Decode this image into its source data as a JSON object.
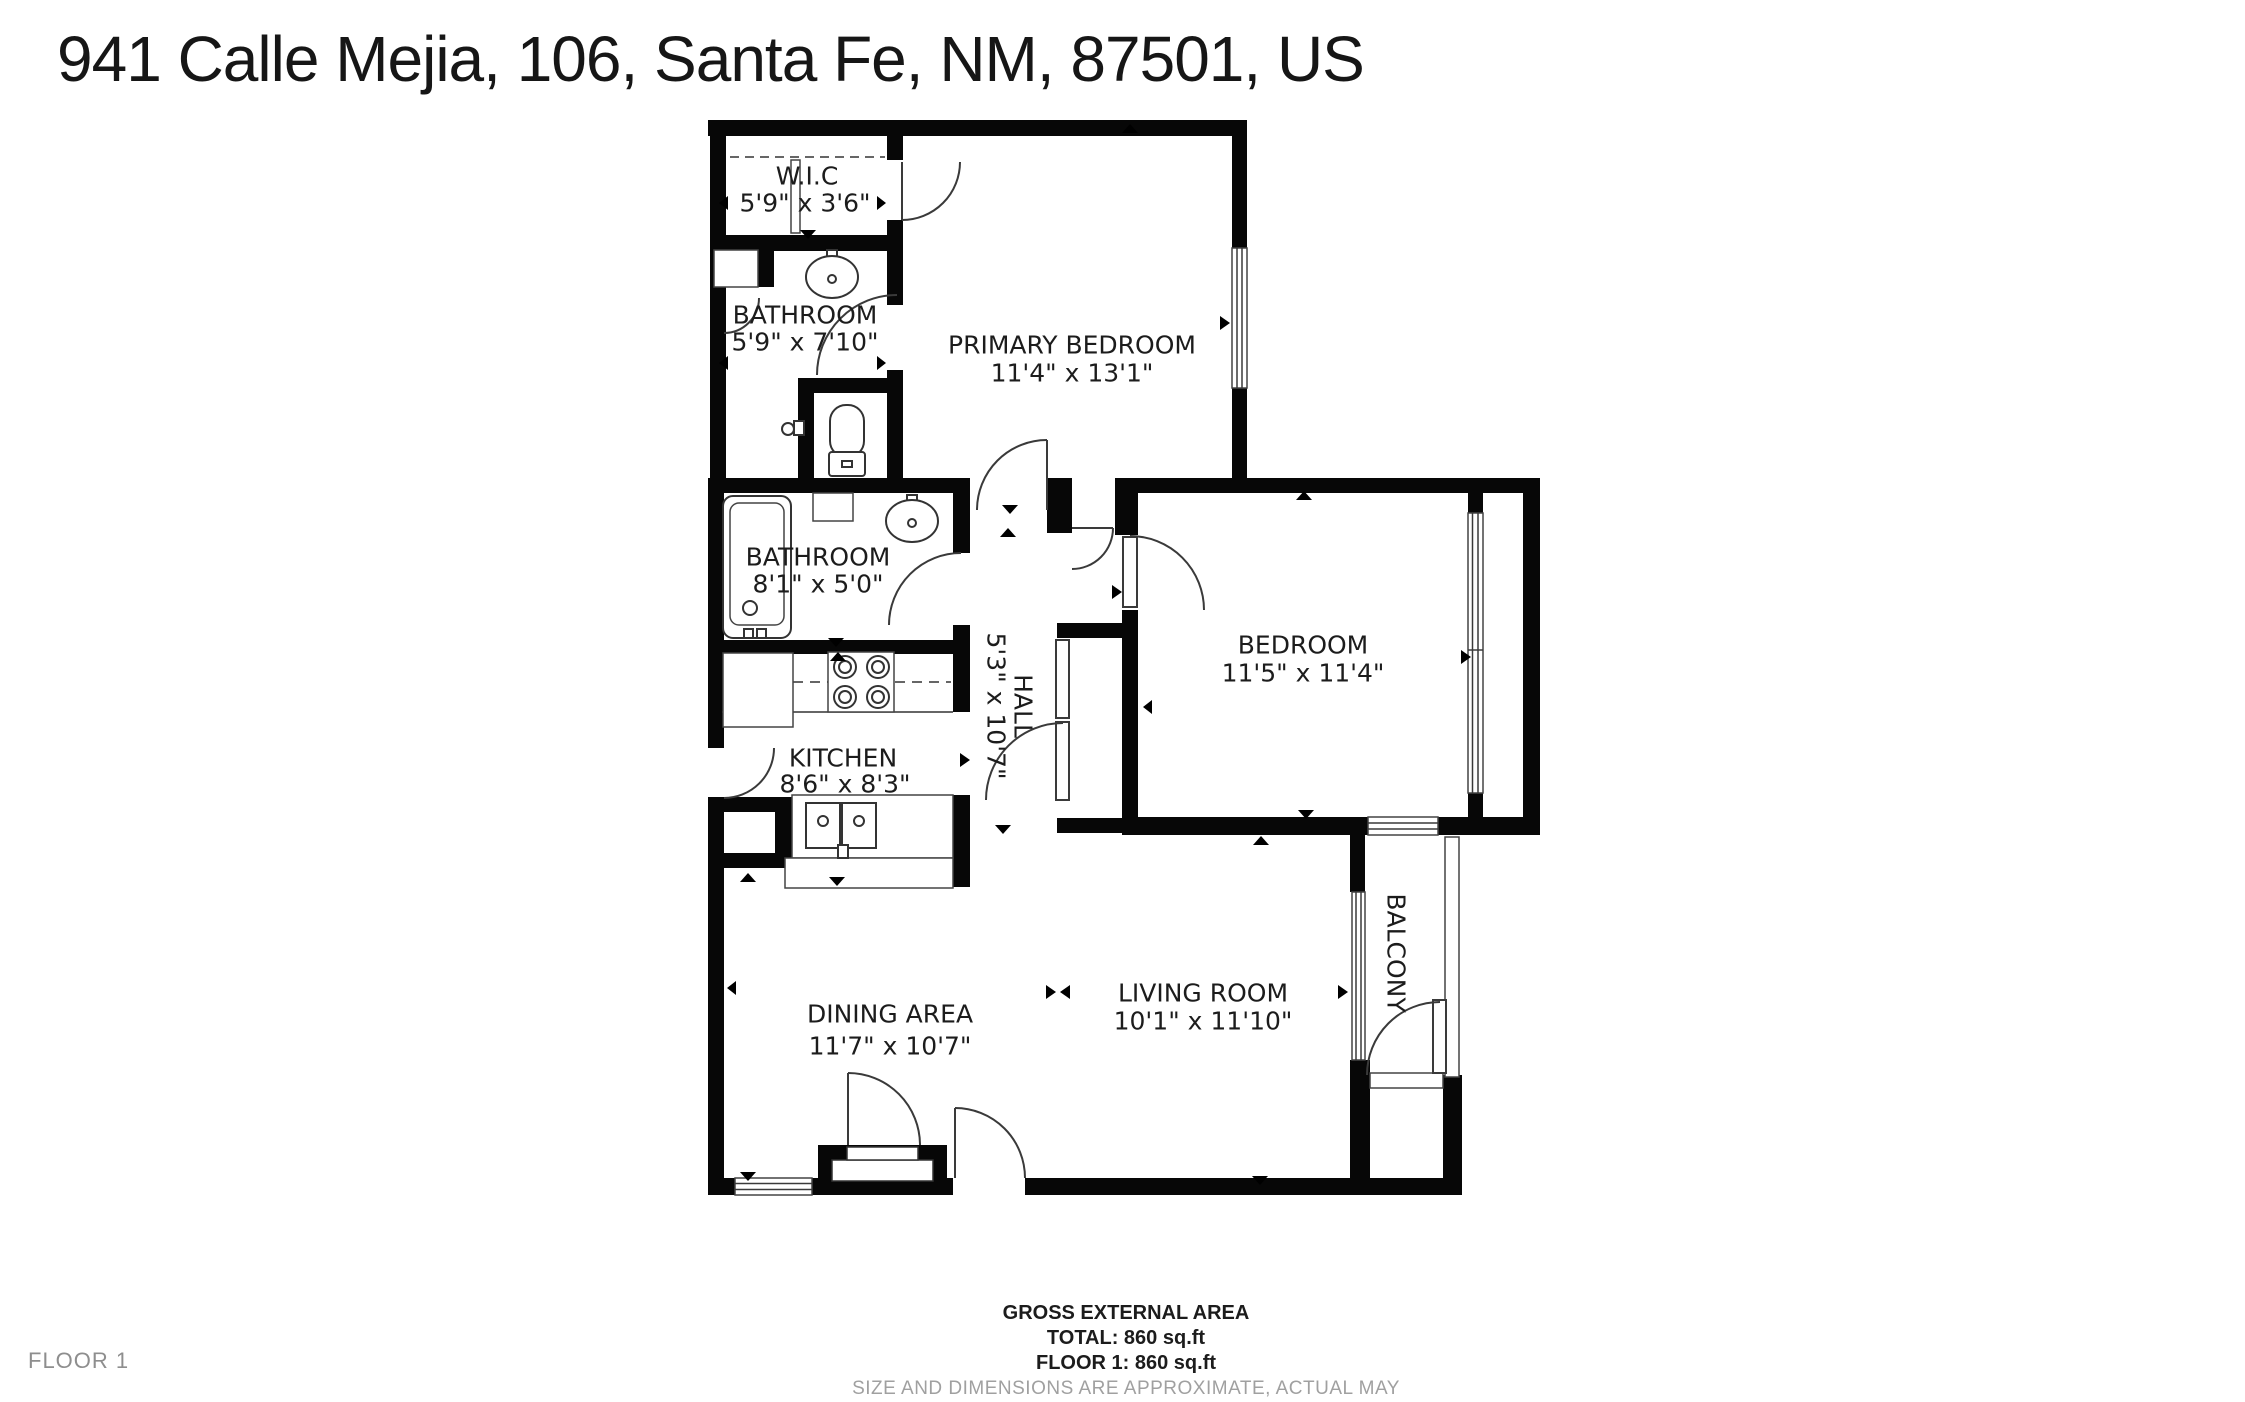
{
  "page": {
    "title": "941 Calle Mejia, 106, Santa Fe, NM, 87501, US"
  },
  "rooms": {
    "wic": {
      "name": "W.I.C",
      "dims": "5'9\" x 3'6\""
    },
    "bathroom1": {
      "name": "BATHROOM",
      "dims": "5'9\" x 7'10\""
    },
    "primary": {
      "name": "PRIMARY BEDROOM",
      "dims": "11'4\" x 13'1\""
    },
    "bathroom2": {
      "name": "BATHROOM",
      "dims": "8'1\" x 5'0\""
    },
    "hall": {
      "name": "HALL",
      "dims": "5'3\" x 10'7\""
    },
    "bedroom": {
      "name": "BEDROOM",
      "dims": "11'5\" x 11'4\""
    },
    "kitchen": {
      "name": "KITCHEN",
      "dims": "8'6\" x 8'3\""
    },
    "dining": {
      "name": "DINING AREA",
      "dims": "11'7\" x 10'7\""
    },
    "living": {
      "name": "LIVING ROOM",
      "dims": "10'1\" x 11'10\""
    },
    "balcony": {
      "name": "BALCONY"
    }
  },
  "footer": {
    "area_title": "GROSS EXTERNAL AREA",
    "total": "TOTAL: 860 sq.ft",
    "floor": "FLOOR 1: 860 sq.ft",
    "disclaimer": "SIZE AND DIMENSIONS ARE APPROXIMATE, ACTUAL MAY VARY",
    "floor_label": "FLOOR 1"
  },
  "colors": {
    "wall": "#070707",
    "background": "#ffffff",
    "line": "#3a3a3a",
    "muted": "#9b9b9b"
  }
}
